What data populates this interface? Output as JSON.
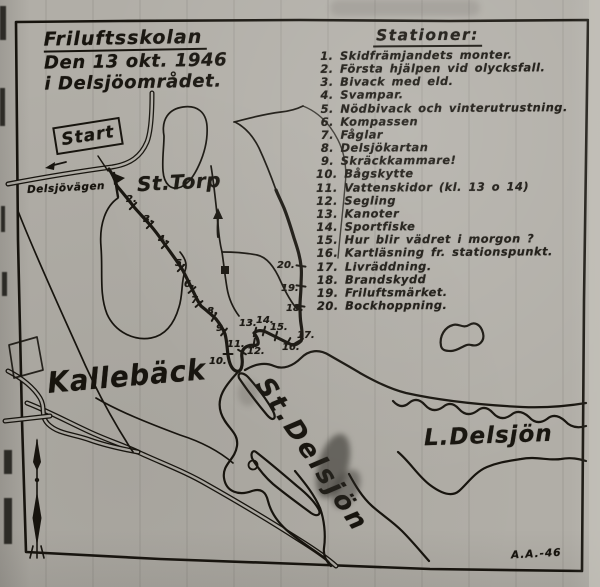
{
  "document": {
    "title_line1": "Friluftsskolan",
    "title_line2": "Den 13 okt. 1946",
    "title_line3": "i Delsjöområdet.",
    "signature": "A.A.-46"
  },
  "stations": {
    "heading": "Stationer:",
    "items": [
      "1. Skidfrämjandets monter.",
      "2. Första hjälpen vid olycksfall.",
      "3. Bivack med eld.",
      "4. Svampar.",
      "5. Nödbivack och vinterutrustning.",
      "6. Kompassen",
      "7. Fåglar",
      "8. Delsjökartan",
      "9. Skräckkammare!",
      "10. Bågskytte",
      "11. Vattenskidor  (kl. 13 o 14)",
      "12. Segling",
      "13. Kanoter",
      "14. Sportfiske",
      "15. Hur blir vädret  i  morgon ?",
      "16. Kartläsning fr. stationspunkt.",
      "17. Livräddning.",
      "18. Brandskydd",
      "19. Friluftsmärket.",
      "20. Bockhoppning."
    ]
  },
  "map": {
    "start_sign": "Start",
    "labels": {
      "road": "Delsjövägen",
      "farm": "St.Torp",
      "district": "Kallebäck",
      "lake_large": "St.Delsjön",
      "lake_small": "L.Delsjön"
    },
    "ink_color": "#17140e",
    "paper_color": "#b1aea7",
    "markers": [
      {
        "n": "2.",
        "x": 126,
        "y": 194,
        "tx": 133,
        "ty": 206,
        "a": -45
      },
      {
        "n": "3.",
        "x": 143,
        "y": 214,
        "tx": 150,
        "ty": 225,
        "a": -45
      },
      {
        "n": "4.",
        "x": 158,
        "y": 234,
        "tx": 165,
        "ty": 245,
        "a": -45
      },
      {
        "n": "5.",
        "x": 175,
        "y": 258,
        "tx": 181,
        "ty": 268,
        "a": -45
      },
      {
        "n": "6.",
        "x": 184,
        "y": 279,
        "tx": 192,
        "ty": 290,
        "a": -40
      },
      {
        "n": "7.",
        "x": 191,
        "y": 295,
        "tx": 199,
        "ty": 304,
        "a": -40
      },
      {
        "n": "8.",
        "x": 207,
        "y": 306,
        "tx": 214,
        "ty": 317,
        "a": -60
      },
      {
        "n": "9.",
        "x": 216,
        "y": 323,
        "tx": 224,
        "ty": 332,
        "a": -50
      },
      {
        "n": "10.",
        "x": 209,
        "y": 356,
        "tx": 228,
        "ty": 354,
        "a": 0
      },
      {
        "n": "11.",
        "x": 227,
        "y": 339,
        "tx": 242,
        "ty": 352,
        "a": 30
      },
      {
        "n": "12.",
        "x": 247,
        "y": 346,
        "tx": 254,
        "ty": 343,
        "a": -80
      },
      {
        "n": "13.",
        "x": 239,
        "y": 318,
        "tx": 255,
        "ty": 332,
        "a": -75
      },
      {
        "n": "14.",
        "x": 256,
        "y": 315,
        "tx": 264,
        "ty": 331,
        "a": -75
      },
      {
        "n": "15.",
        "x": 270,
        "y": 322,
        "tx": 276,
        "ty": 336,
        "a": -75
      },
      {
        "n": "16.",
        "x": 282,
        "y": 342,
        "tx": 288,
        "ty": 342,
        "a": -60
      },
      {
        "n": "17.",
        "x": 297,
        "y": 330,
        "tx": 299,
        "ty": 341,
        "a": -30
      },
      {
        "n": "18.",
        "x": 286,
        "y": 303,
        "tx": 300,
        "ty": 306,
        "a": 8
      },
      {
        "n": "19.",
        "x": 281,
        "y": 283,
        "tx": 301,
        "ty": 286,
        "a": 8
      },
      {
        "n": "20.",
        "x": 277,
        "y": 260,
        "tx": 301,
        "ty": 266,
        "a": 8
      }
    ]
  }
}
